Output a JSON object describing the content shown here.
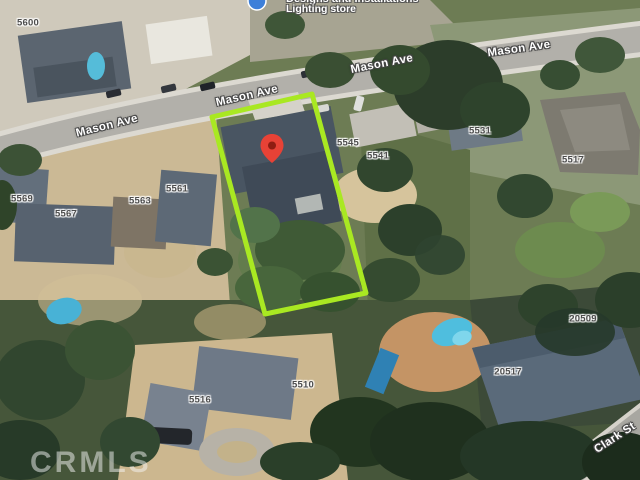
{
  "map_type": "satellite",
  "poi": {
    "name": "Designs and Installations",
    "category": "Lighting store"
  },
  "streets": {
    "mason_ave": "Mason Ave",
    "clark_st": "Clark St"
  },
  "addresses": {
    "n5600": "5600",
    "n5569": "5569",
    "n5567": "5567",
    "n5563": "5563",
    "n5561": "5561",
    "n5545": "5545",
    "n5541": "5541",
    "n5531": "5531",
    "n5517": "5517",
    "n5516": "5516",
    "n5510": "5510",
    "n20509": "20509",
    "n20517": "20517"
  },
  "watermark": "CRMLS",
  "colors": {
    "parcel_outline": "#a9e822",
    "marker": "#e74236",
    "marker_dot": "#8e1d12",
    "poi_icon": "#3d7fd9"
  }
}
